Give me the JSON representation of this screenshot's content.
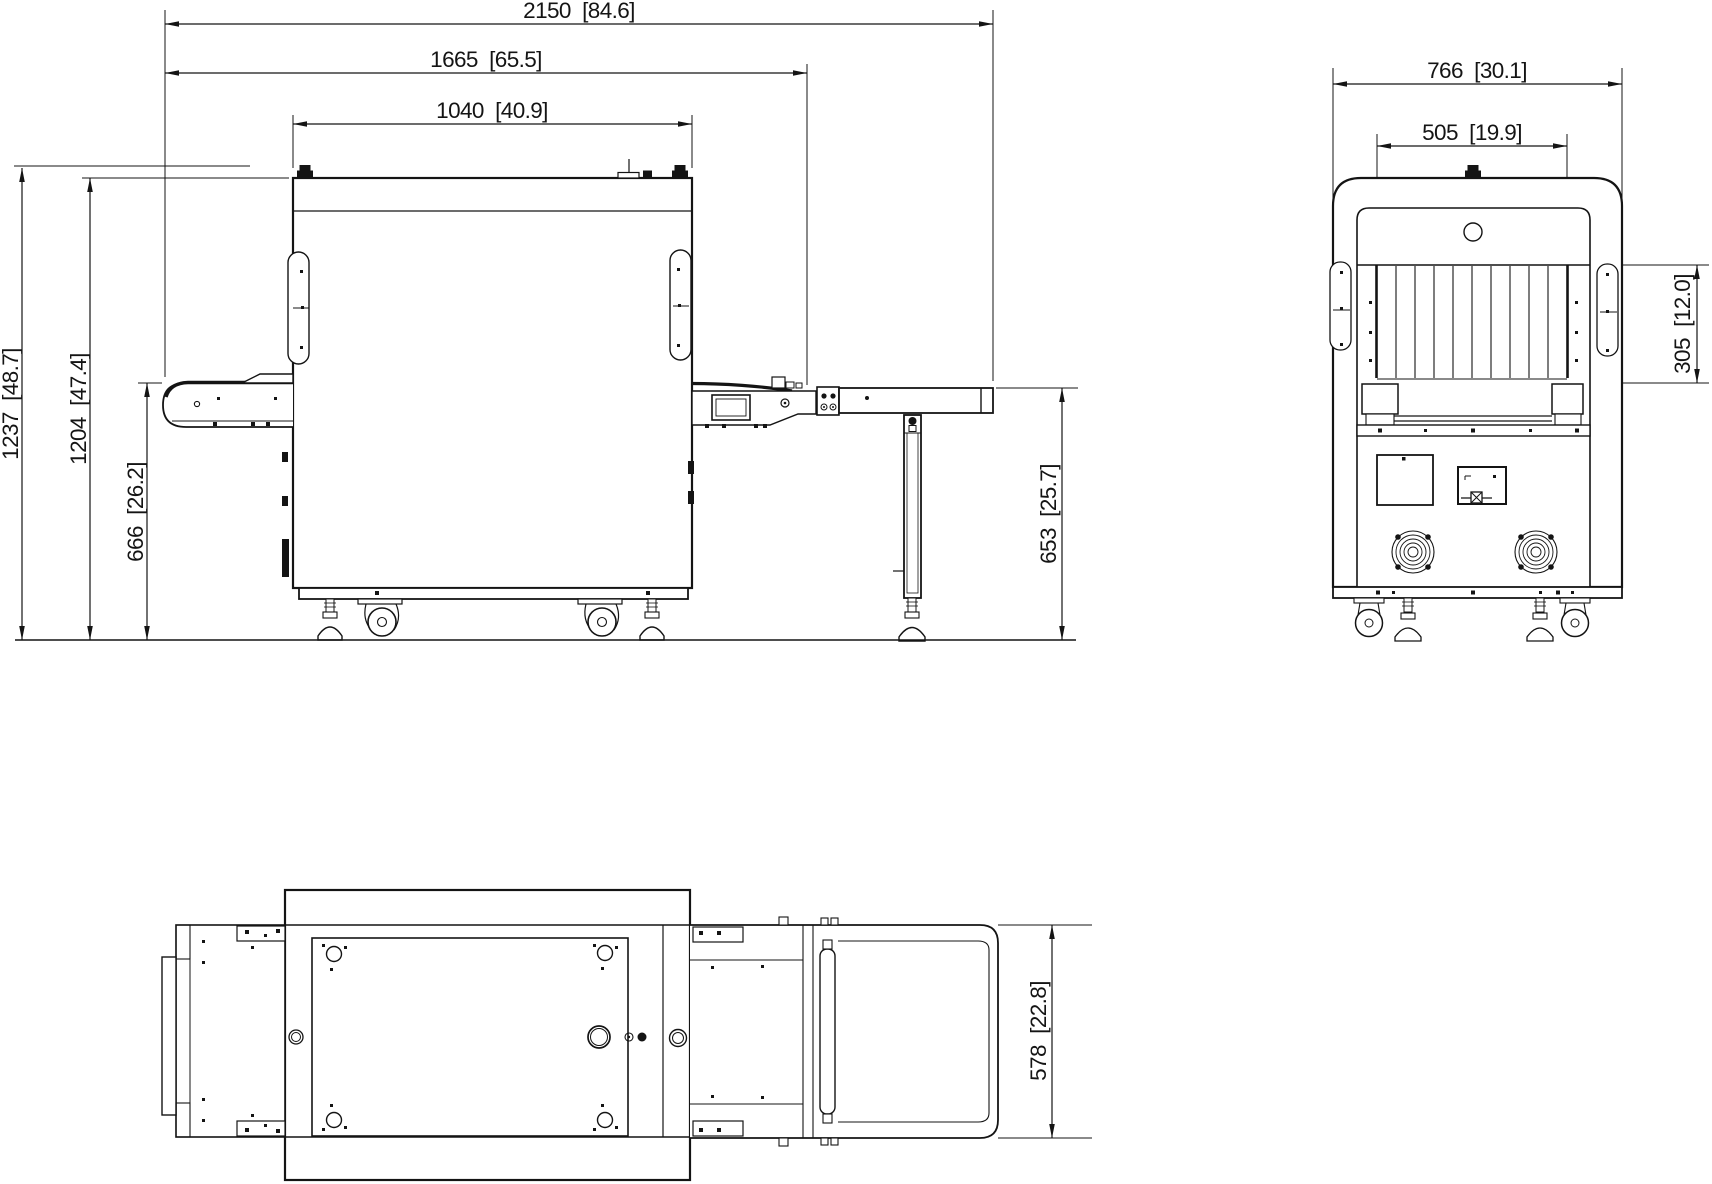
{
  "page": {
    "background": "#ffffff",
    "ink": "#141414",
    "units_format": "mm [inch]"
  },
  "views": {
    "side_view": "side-elevation-view",
    "front_view": "front-elevation-view",
    "top_view": "top-plan-view"
  },
  "dimensions": {
    "side": {
      "overall_length": "2150  [84.6]",
      "conveyor_length": "1665  [65.5]",
      "cabinet_length": "1040  [40.9]",
      "overall_height": "1237  [48.7]",
      "cabinet_height": "1204  [47.4]",
      "belt_height": "666  [26.2]",
      "table_height": "653  [25.7]"
    },
    "front": {
      "overall_width": "766  [30.1]",
      "tunnel_width": "505  [19.9]",
      "tunnel_height": "305  [12.0]"
    },
    "top": {
      "conveyor_width": "578  [22.8]"
    }
  }
}
